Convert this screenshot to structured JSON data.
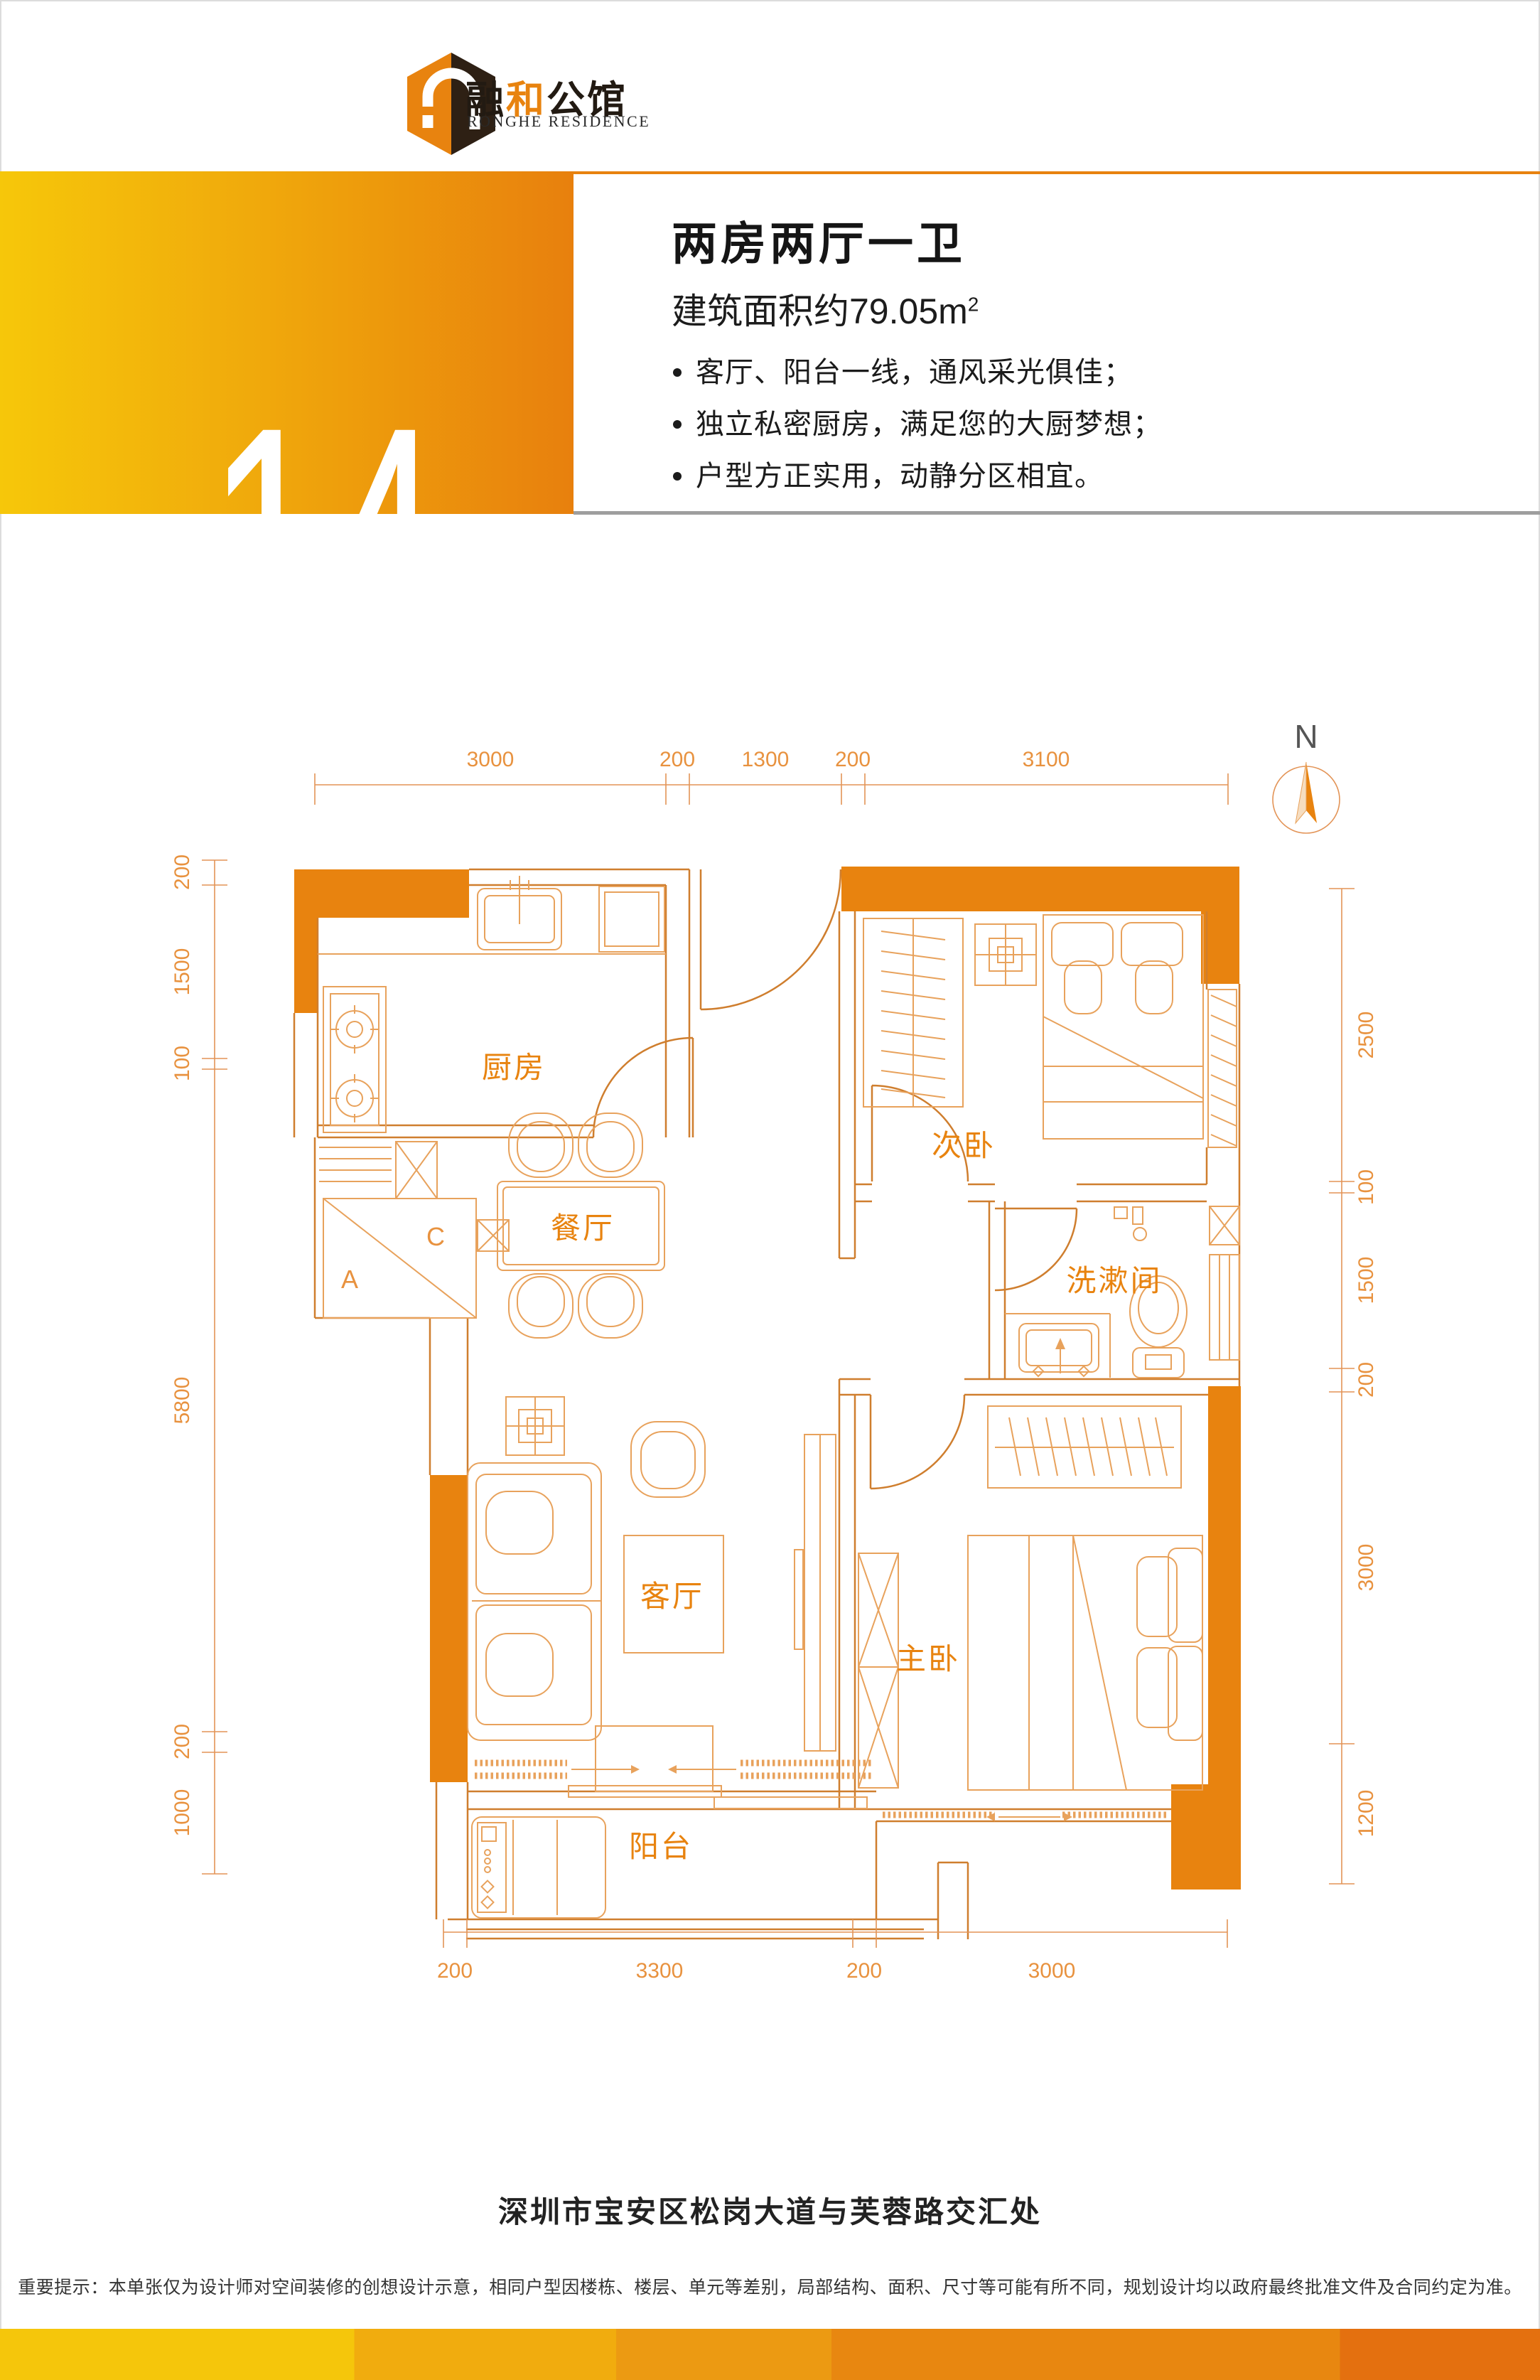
{
  "brand": {
    "zh_part1": "融",
    "zh_part2": "和",
    "zh_part3": "公馆",
    "en": "RONGHE RESIDENCE"
  },
  "unit": {
    "code_prefix": "M",
    "code_number": "14",
    "title": "两房两厅一卫",
    "area_label": "建筑面积约79.05m",
    "area_sup": "2",
    "features": [
      "客厅、阳台一线，通风采光俱佳；",
      "独立私密厨房，满足您的大厨梦想；",
      "户型方正实用，动静分区相宜。"
    ]
  },
  "plan": {
    "compass": "N",
    "rooms": {
      "kitchen": "厨房",
      "second_bedroom": "次卧",
      "dining": "餐厅",
      "washroom": "洗漱间",
      "living": "客厅",
      "master_bedroom": "主卧",
      "balcony": "阳台"
    },
    "shaft_labels": {
      "a": "A",
      "c": "C"
    },
    "dims": {
      "top": [
        "3000",
        "200",
        "1300",
        "200",
        "3100"
      ],
      "left": [
        "200",
        "1500",
        "100",
        "5800",
        "200",
        "1000"
      ],
      "right": [
        "2500",
        "100",
        "1500",
        "200",
        "3000",
        "1200"
      ],
      "bottom": [
        "200",
        "3300",
        "200",
        "3000"
      ]
    }
  },
  "footer": {
    "address": "深圳市宝安区松岗大道与芙蓉路交汇处",
    "disclaimer": "重要提示：本单张仅为设计师对空间装修的创想设计示意，相同户型因楼栋、楼层、单元等差别，局部结构、面积、尺寸等可能有所不同，规划设计均以政府最终批准文件及合同约定为准。"
  },
  "colors": {
    "accent_orange": "#E8830F",
    "gradient_start": "#F6C70A",
    "gradient_end": "#E8800D",
    "plan_line": "#CF7E2E",
    "text_dark": "#1B1B1B"
  }
}
